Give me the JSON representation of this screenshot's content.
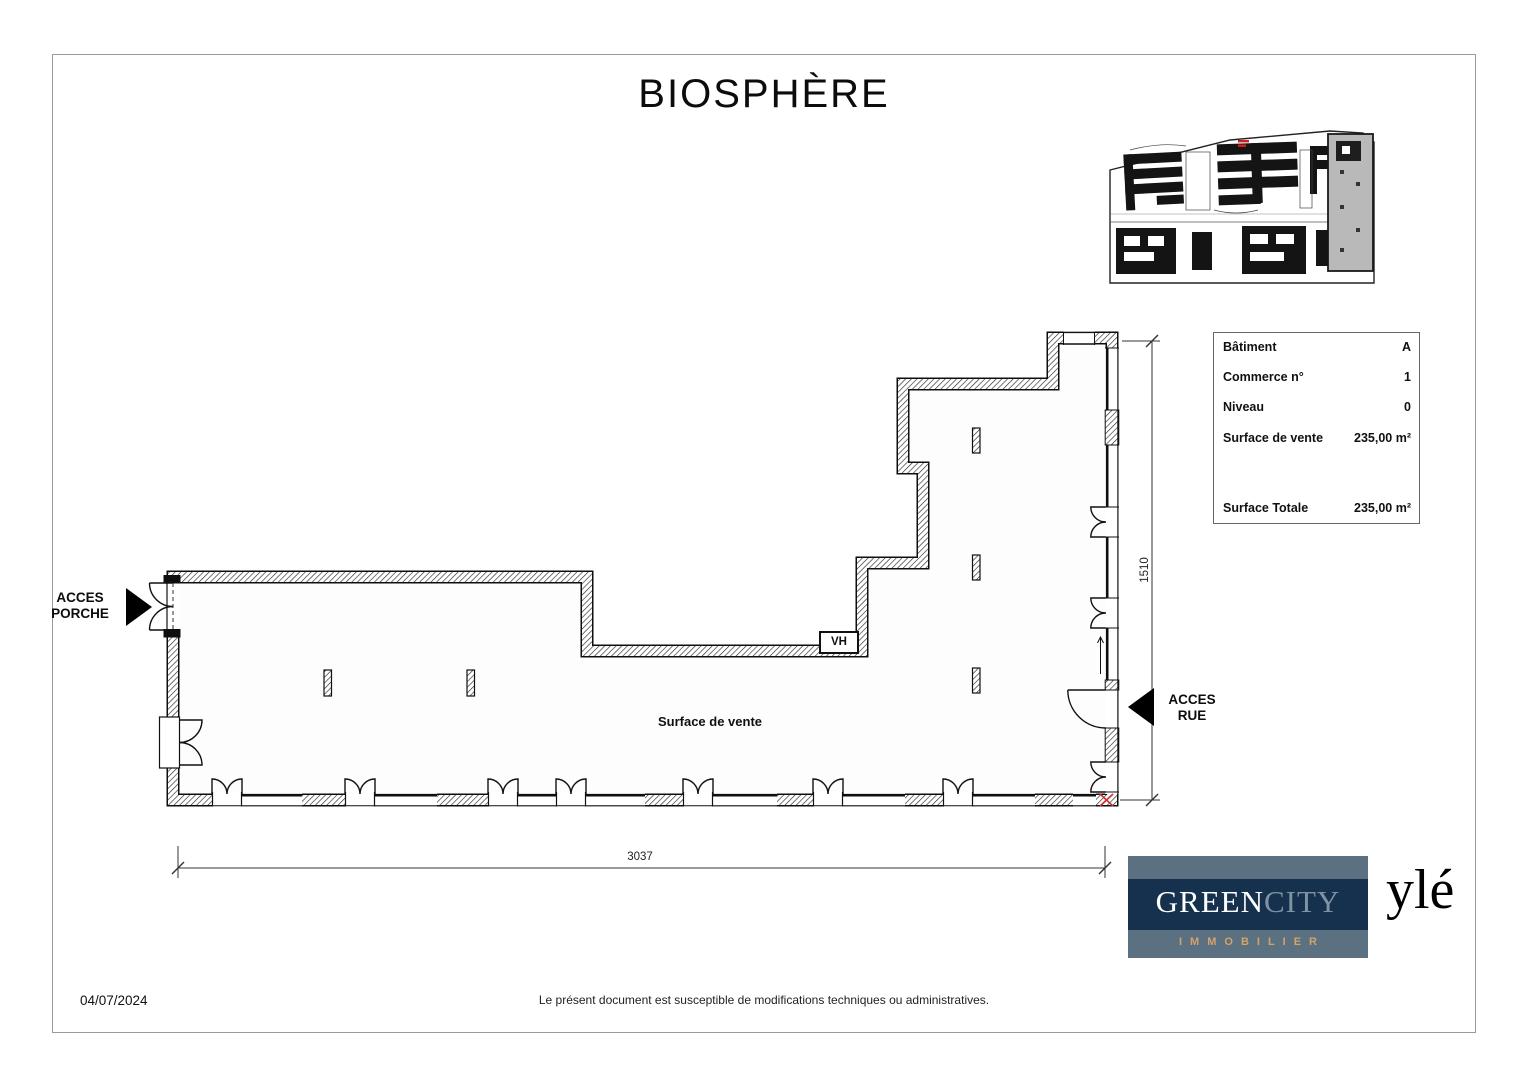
{
  "page": {
    "title": "BIOSPHÈRE",
    "date": "04/07/2024",
    "disclaimer": "Le présent document est susceptible de modifications techniques ou administratives."
  },
  "info_table": {
    "rows": [
      {
        "label": "Bâtiment",
        "value": "A"
      },
      {
        "label": "Commerce n°",
        "value": "1"
      },
      {
        "label": "Niveau",
        "value": "0"
      },
      {
        "label": "Surface de vente",
        "value": "235,00 m²"
      },
      {
        "label": "Surface Totale",
        "value": "235,00 m²"
      }
    ]
  },
  "plan": {
    "room_label": "Surface de vente",
    "vh_label": "VH",
    "access_porche": {
      "line1": "ACCES",
      "line2": "PORCHE"
    },
    "access_rue": {
      "line1": "ACCES",
      "line2": "RUE"
    },
    "dimensions": {
      "width_label": "3037",
      "height_label": "1510"
    }
  },
  "logos": {
    "greencity": {
      "part1": "GREEN",
      "part2": "CITY",
      "subtitle": "IMMOBILIER",
      "colors": {
        "slate": "#5b7080",
        "navy": "#16314e",
        "gold": "#d2a467",
        "city_gray": "#7e93a4"
      }
    },
    "yle": "ylé"
  }
}
